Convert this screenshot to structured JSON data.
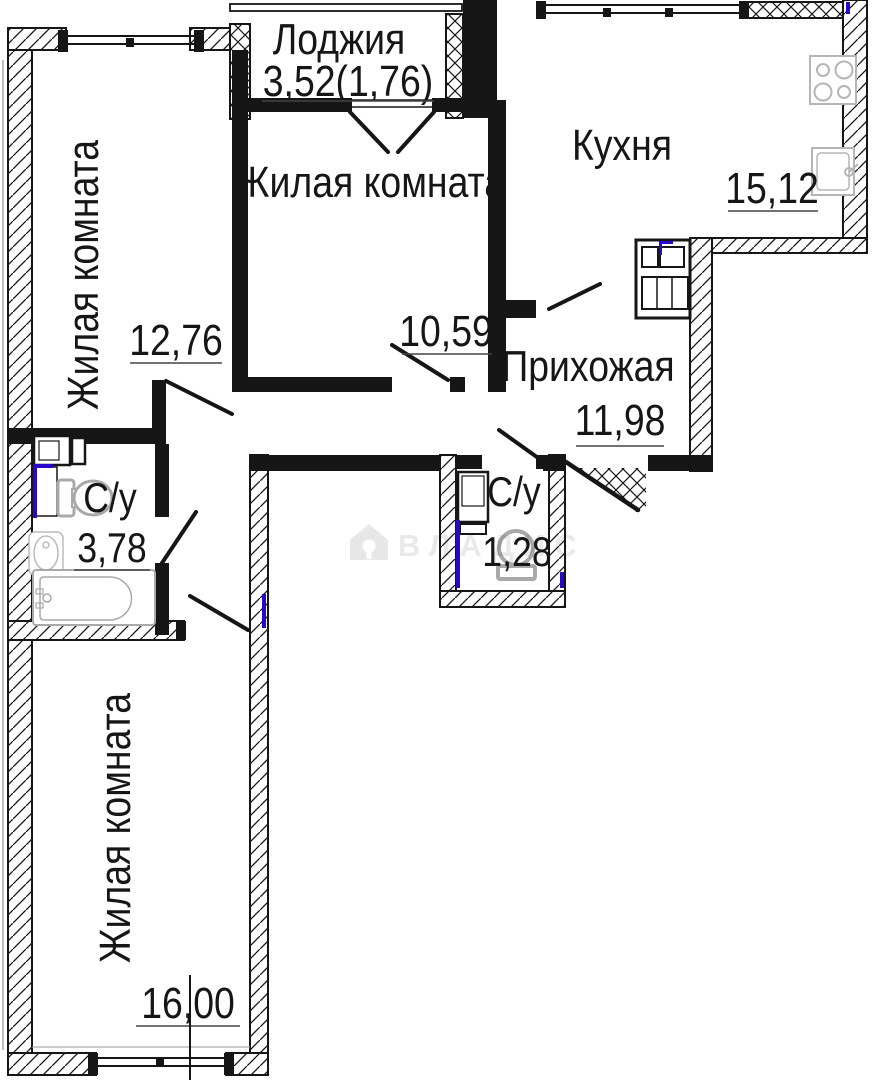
{
  "plan": {
    "watermark": {
      "brand": "ВЛАДИС",
      "icon": "house-key-icon"
    },
    "rooms": [
      {
        "key": "loggia",
        "label": "Лоджия",
        "area": "3,52(1,76)"
      },
      {
        "key": "living-room-left",
        "label": "Жилая комната",
        "area": "12,76"
      },
      {
        "key": "living-room-middle",
        "label": "Жилая комната",
        "area": "10,59"
      },
      {
        "key": "kitchen",
        "label": "Кухня",
        "area": "15,12"
      },
      {
        "key": "hallway",
        "label": "Прихожая",
        "area": "11,98"
      },
      {
        "key": "bathroom",
        "label": "С/у",
        "area": "3,78"
      },
      {
        "key": "wc",
        "label": "С/у",
        "area": "1,28"
      },
      {
        "key": "living-room-bottom",
        "label": "Жилая комната",
        "area": "16,00"
      }
    ],
    "fixtures": [
      "stove-icon",
      "kitchen-sink-icon",
      "toilet-icon",
      "washbasin-icon",
      "bathtub-icon",
      "washing-machine-icon",
      "vent-shaft-icon"
    ],
    "colors": {
      "walls": "#161616",
      "fixtures": "#a9a9a9",
      "plumbing_mark": "#2a06c8",
      "watermark": "#e9e9e9"
    }
  }
}
